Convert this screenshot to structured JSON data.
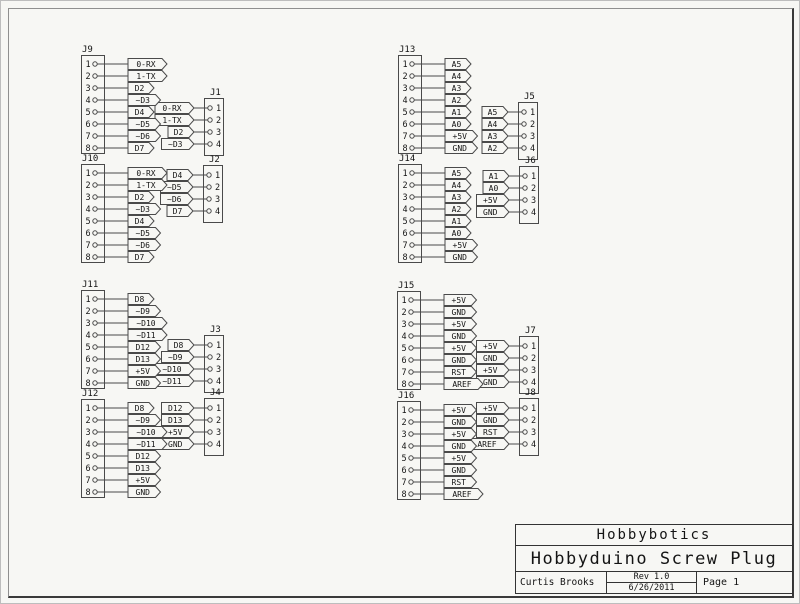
{
  "colors": {
    "sheet_bg": "#f7f7f4",
    "line": "#4a4a4a",
    "text": "#141414",
    "frame_light": "#8f8f8f",
    "frame_dark": "#3a3a3a"
  },
  "title_block": {
    "company": "Hobbybotics",
    "title": "Hobbyduino Screw Plug",
    "author": "Curtis Brooks",
    "revision": "Rev 1.0",
    "date": "6/26/2011",
    "page": "Page 1"
  },
  "connectors": [
    {
      "id": "J1",
      "type": "4pin",
      "x": 203,
      "y": 97,
      "pins": [
        {
          "n": 1,
          "label": "0-RX"
        },
        {
          "n": 2,
          "label": "1-TX"
        },
        {
          "n": 3,
          "label": "D2"
        },
        {
          "n": 4,
          "label": "~D3"
        }
      ]
    },
    {
      "id": "J2",
      "type": "4pin",
      "x": 202,
      "y": 164,
      "pins": [
        {
          "n": 1,
          "label": "D4"
        },
        {
          "n": 2,
          "label": "~D5"
        },
        {
          "n": 3,
          "label": "~D6"
        },
        {
          "n": 4,
          "label": "D7"
        }
      ]
    },
    {
      "id": "J3",
      "type": "4pin",
      "x": 203,
      "y": 334,
      "pins": [
        {
          "n": 1,
          "label": "D8"
        },
        {
          "n": 2,
          "label": "~D9"
        },
        {
          "n": 3,
          "label": "~D10"
        },
        {
          "n": 4,
          "label": "~D11"
        }
      ]
    },
    {
      "id": "J4",
      "type": "4pin",
      "x": 203,
      "y": 397,
      "pins": [
        {
          "n": 1,
          "label": "D12"
        },
        {
          "n": 2,
          "label": "D13"
        },
        {
          "n": 3,
          "label": "+5V"
        },
        {
          "n": 4,
          "label": "GND"
        }
      ]
    },
    {
      "id": "J5",
      "type": "4pin",
      "x": 517,
      "y": 101,
      "pins": [
        {
          "n": 1,
          "label": "A5"
        },
        {
          "n": 2,
          "label": "A4"
        },
        {
          "n": 3,
          "label": "A3"
        },
        {
          "n": 4,
          "label": "A2"
        }
      ]
    },
    {
      "id": "J6",
      "type": "4pin",
      "x": 518,
      "y": 165,
      "pins": [
        {
          "n": 1,
          "label": "A1"
        },
        {
          "n": 2,
          "label": "A0"
        },
        {
          "n": 3,
          "label": "+5V"
        },
        {
          "n": 4,
          "label": "GND"
        }
      ]
    },
    {
      "id": "J7",
      "type": "4pin",
      "x": 518,
      "y": 335,
      "pins": [
        {
          "n": 1,
          "label": "+5V"
        },
        {
          "n": 2,
          "label": "GND"
        },
        {
          "n": 3,
          "label": "+5V"
        },
        {
          "n": 4,
          "label": "GND"
        }
      ]
    },
    {
      "id": "J8",
      "type": "4pin",
      "x": 518,
      "y": 397,
      "pins": [
        {
          "n": 1,
          "label": "+5V"
        },
        {
          "n": 2,
          "label": "GND"
        },
        {
          "n": 3,
          "label": "RST"
        },
        {
          "n": 4,
          "label": "AREF"
        }
      ]
    },
    {
      "id": "J9",
      "type": "8pin",
      "x": 80,
      "y": 54,
      "pins": [
        {
          "n": 1,
          "label": "0-RX"
        },
        {
          "n": 2,
          "label": "1-TX"
        },
        {
          "n": 3,
          "label": "D2"
        },
        {
          "n": 4,
          "label": "~D3"
        },
        {
          "n": 5,
          "label": "D4"
        },
        {
          "n": 6,
          "label": "~D5"
        },
        {
          "n": 7,
          "label": "~D6"
        },
        {
          "n": 8,
          "label": "D7"
        }
      ]
    },
    {
      "id": "J10",
      "type": "8pin",
      "x": 80,
      "y": 163,
      "pins": [
        {
          "n": 1,
          "label": "0-RX"
        },
        {
          "n": 2,
          "label": "1-TX"
        },
        {
          "n": 3,
          "label": "D2"
        },
        {
          "n": 4,
          "label": "~D3"
        },
        {
          "n": 5,
          "label": "D4"
        },
        {
          "n": 6,
          "label": "~D5"
        },
        {
          "n": 7,
          "label": "~D6"
        },
        {
          "n": 8,
          "label": "D7"
        }
      ]
    },
    {
      "id": "J11",
      "type": "8pin",
      "x": 80,
      "y": 289,
      "pins": [
        {
          "n": 1,
          "label": "D8"
        },
        {
          "n": 2,
          "label": "~D9"
        },
        {
          "n": 3,
          "label": "~D10"
        },
        {
          "n": 4,
          "label": "~D11"
        },
        {
          "n": 5,
          "label": "D12"
        },
        {
          "n": 6,
          "label": "D13"
        },
        {
          "n": 7,
          "label": "+5V"
        },
        {
          "n": 8,
          "label": "GND"
        }
      ]
    },
    {
      "id": "J12",
      "type": "8pin",
      "x": 80,
      "y": 398,
      "pins": [
        {
          "n": 1,
          "label": "D8"
        },
        {
          "n": 2,
          "label": "~D9"
        },
        {
          "n": 3,
          "label": "~D10"
        },
        {
          "n": 4,
          "label": "~D11"
        },
        {
          "n": 5,
          "label": "D12"
        },
        {
          "n": 6,
          "label": "D13"
        },
        {
          "n": 7,
          "label": "+5V"
        },
        {
          "n": 8,
          "label": "GND"
        }
      ]
    },
    {
      "id": "J13",
      "type": "8pin",
      "x": 397,
      "y": 54,
      "pins": [
        {
          "n": 1,
          "label": "A5"
        },
        {
          "n": 2,
          "label": "A4"
        },
        {
          "n": 3,
          "label": "A3"
        },
        {
          "n": 4,
          "label": "A2"
        },
        {
          "n": 5,
          "label": "A1"
        },
        {
          "n": 6,
          "label": "A0"
        },
        {
          "n": 7,
          "label": "+5V"
        },
        {
          "n": 8,
          "label": "GND"
        }
      ]
    },
    {
      "id": "J14",
      "type": "8pin",
      "x": 397,
      "y": 163,
      "pins": [
        {
          "n": 1,
          "label": "A5"
        },
        {
          "n": 2,
          "label": "A4"
        },
        {
          "n": 3,
          "label": "A3"
        },
        {
          "n": 4,
          "label": "A2"
        },
        {
          "n": 5,
          "label": "A1"
        },
        {
          "n": 6,
          "label": "A0"
        },
        {
          "n": 7,
          "label": "+5V"
        },
        {
          "n": 8,
          "label": "GND"
        }
      ]
    },
    {
      "id": "J15",
      "type": "8pin",
      "x": 396,
      "y": 290,
      "pins": [
        {
          "n": 1,
          "label": "+5V"
        },
        {
          "n": 2,
          "label": "GND"
        },
        {
          "n": 3,
          "label": "+5V"
        },
        {
          "n": 4,
          "label": "GND"
        },
        {
          "n": 5,
          "label": "+5V"
        },
        {
          "n": 6,
          "label": "GND"
        },
        {
          "n": 7,
          "label": "RST"
        },
        {
          "n": 8,
          "label": "AREF"
        }
      ]
    },
    {
      "id": "J16",
      "type": "8pin",
      "x": 396,
      "y": 400,
      "pins": [
        {
          "n": 1,
          "label": "+5V"
        },
        {
          "n": 2,
          "label": "GND"
        },
        {
          "n": 3,
          "label": "+5V"
        },
        {
          "n": 4,
          "label": "GND"
        },
        {
          "n": 5,
          "label": "+5V"
        },
        {
          "n": 6,
          "label": "GND"
        },
        {
          "n": 7,
          "label": "RST"
        },
        {
          "n": 8,
          "label": "AREF"
        }
      ]
    }
  ]
}
